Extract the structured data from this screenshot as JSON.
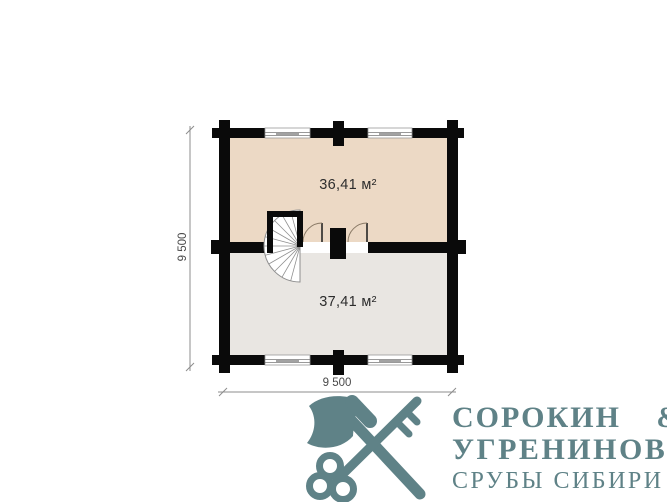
{
  "plan": {
    "upper_room_area": "36,41 м²",
    "lower_room_area": "37,41 м²",
    "vertical_dimension": "9 500",
    "horizontal_dimension": "9 500",
    "colors": {
      "upper_room_fill": "#ecd9c5",
      "lower_room_fill": "#e9e6e2",
      "walls": "#0a0a0a",
      "dimension_lines": "#8c8c8c"
    }
  },
  "logo": {
    "name_line1": "СОРОКИН &",
    "name_line2": "УГРЕНИНОВ",
    "tagline": "СРУБЫ СИБИРИ",
    "brand_color": "#5f8287",
    "icon": "crossed-axe-and-key"
  }
}
